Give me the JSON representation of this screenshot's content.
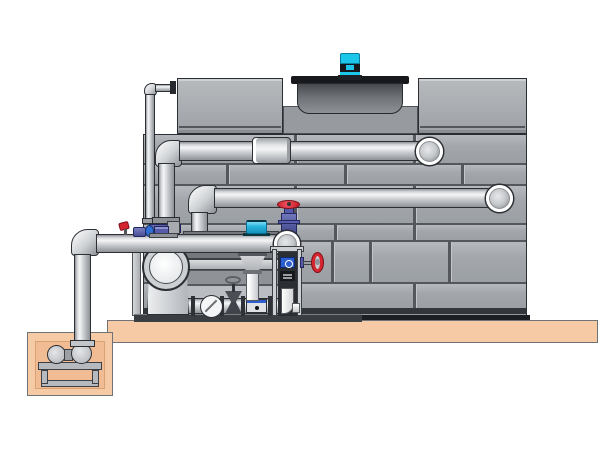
{
  "meta": {
    "title": "Closed-circuit cooling tower with pump skid and sump pit — technical illustration",
    "canvas": {
      "width": 600,
      "height": 450
    }
  },
  "palette": {
    "background": "#ffffff",
    "outline": "#2c2f34",
    "seam": "#54575c",
    "tank_gray": "#a6a9ad",
    "recess_gray": "#979a9f",
    "shroud_dark": "#46494d",
    "flange_black": "#17191d",
    "motor_cyan": "#1cc5ea",
    "pipe_light": "#f4f5f6",
    "pipe_mid": "#c7cacd",
    "pipe_dark": "#8f9296",
    "slab_tan": "#f6caa4",
    "pit_tan": "#f1bc93",
    "valve_red": "#d42531",
    "valve_purple": "#565baa",
    "actuator_cyan": "#29b5dd",
    "label_blue": "#2e5fd0",
    "base_dark": "#33363b",
    "skid_dark": "#75787d",
    "skid_panel": "#babdc1"
  },
  "components": {
    "tower": [
      "panelized-cabinet",
      "left-top-box",
      "right-top-box",
      "fan-recess",
      "fan-shroud",
      "fan-motor"
    ],
    "pipes": [
      "upper-return-pipe",
      "middle-supply-pipe",
      "main-discharge-pipe",
      "equalizer-standpipe",
      "sump-riser-pipe"
    ],
    "pump_skid": [
      "end-suction-pump",
      "check-valve",
      "gate-valve",
      "suction-diffuser",
      "instrument-stand",
      "skid-base"
    ],
    "valves": [
      "red-globe-valve",
      "red-side-handwheel-valve",
      "red-lever-ball-valve",
      "cyan-actuator-valve",
      "purple-inline-fittings"
    ],
    "sump": [
      "concrete-pit",
      "sump-pump",
      "pump-platform"
    ],
    "foundation": [
      "concrete-slab"
    ]
  }
}
